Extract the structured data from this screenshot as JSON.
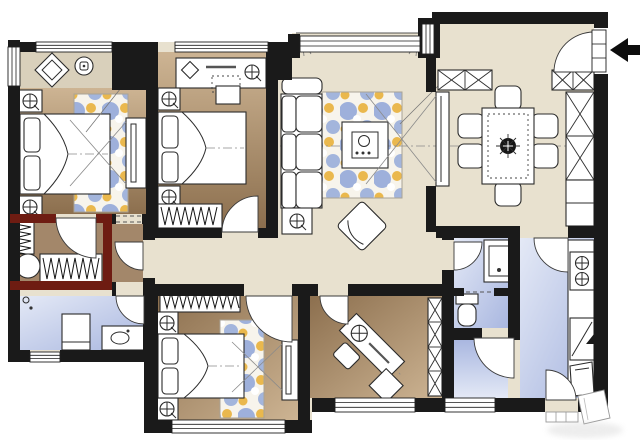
{
  "palette": {
    "wall": "#1a1a1a",
    "closet_wall": "#6e1c12",
    "floor_living": "#e8e1cf",
    "floor_bay": "#d9d0bb",
    "floor_bedroom_light": "#cdb493",
    "floor_bedroom_dark": "#8c6f4e",
    "floor_bath_light": "#e4e9f6",
    "floor_bath_dark": "#a9b7e0",
    "floor_closet": "#a3876a",
    "rug_base": "#f7f4ec",
    "rug_blue": "#8ea5d8",
    "rug_yellow": "#e9b23c",
    "furniture_fill": "#ffffff",
    "furniture_line": "#2b2b2b",
    "sightline": "#8a8a8a",
    "entry_arrow": "#0d0d0d",
    "watermark": "#c4c4c4"
  },
  "plan": {
    "canvas": {
      "width": 640,
      "height": 442
    },
    "type": "apartment-floor-plan",
    "entry_arrow_direction": "left",
    "rooms": [
      "entry",
      "dining-area",
      "living-room",
      "master-bedroom",
      "bedroom-2",
      "bedroom-3",
      "study",
      "walk-in-closet",
      "master-bathroom",
      "bathroom-2",
      "laundry-room",
      "kitchen",
      "hallway",
      "bay-window-nook"
    ],
    "furniture_icons": [
      "double-bed",
      "pillow",
      "nightstand-with-lamp",
      "area-rug",
      "runner-rug",
      "tv-cabinet",
      "sight-line",
      "wardrobe-hanging-rail",
      "dressing-desk",
      "desk-stool",
      "sofa",
      "sofa-side-table",
      "coffee-table-with-tea-set",
      "lounge-chair",
      "dining-table",
      "dining-chair",
      "plant-centerpiece",
      "shoe-cabinet",
      "storage-cabinet",
      "bookshelf",
      "corner-desk",
      "desk-chair",
      "desk-lamp",
      "toilet",
      "vanity-sink",
      "shower-head",
      "shower-tray",
      "round-ottoman",
      "gas-stove",
      "kitchen-counter",
      "kitchen-cabinet",
      "door-swing",
      "window",
      "bay-window",
      "curtain",
      "entry-arrow",
      "step-landing"
    ],
    "counts": {
      "bedrooms": 3,
      "bathrooms": 2,
      "beds": 3,
      "dining_chairs": 6,
      "stove_burners": 2
    }
  }
}
